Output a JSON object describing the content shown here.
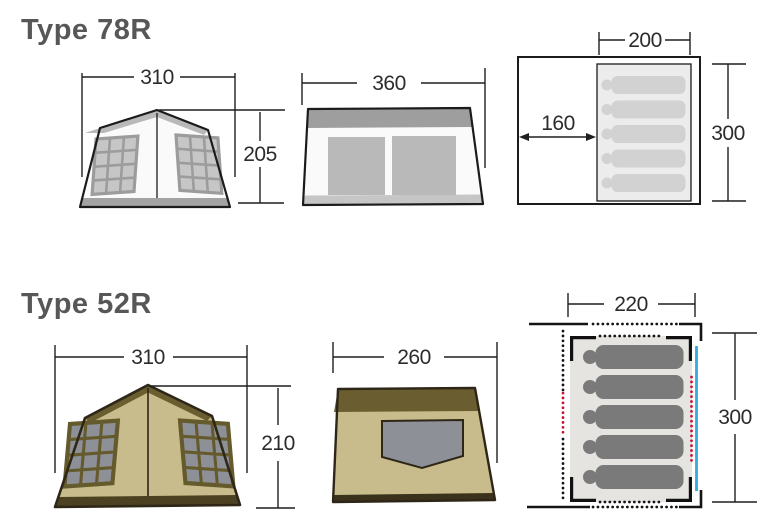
{
  "type78r": {
    "title": "Type 78R",
    "front": {
      "width": "310",
      "height": "205"
    },
    "side": {
      "depth": "360"
    },
    "plan": {
      "inner_width": "200",
      "porch_depth": "160",
      "inner_length": "300",
      "sleeper_count": 5
    }
  },
  "type52r": {
    "title": "Type 52R",
    "front": {
      "width": "310",
      "height": "210"
    },
    "side": {
      "depth": "260"
    },
    "plan": {
      "inner_width": "220",
      "inner_length": "300",
      "sleeper_count": 5
    }
  },
  "colors": {
    "title_text": "#575757",
    "dimension_line": "#1f1f1f",
    "tent_78r_body": "#fafafa",
    "tent_78r_trim": "#9e9e9e",
    "tent_78r_window": "#c6c6c6",
    "tent_52r_body": "#c9bc8c",
    "tent_52r_trim": "#6a5e30",
    "tent_52r_window": "#8d9097",
    "plan_mat_light": "#ececec",
    "plan_mat_warm": "#e6e4e0",
    "sleeper_light": "#d2d2d2",
    "sleeper_dark": "#7a7a7a",
    "marker_red": "#c8102e",
    "marker_blue": "#35a8e0"
  }
}
